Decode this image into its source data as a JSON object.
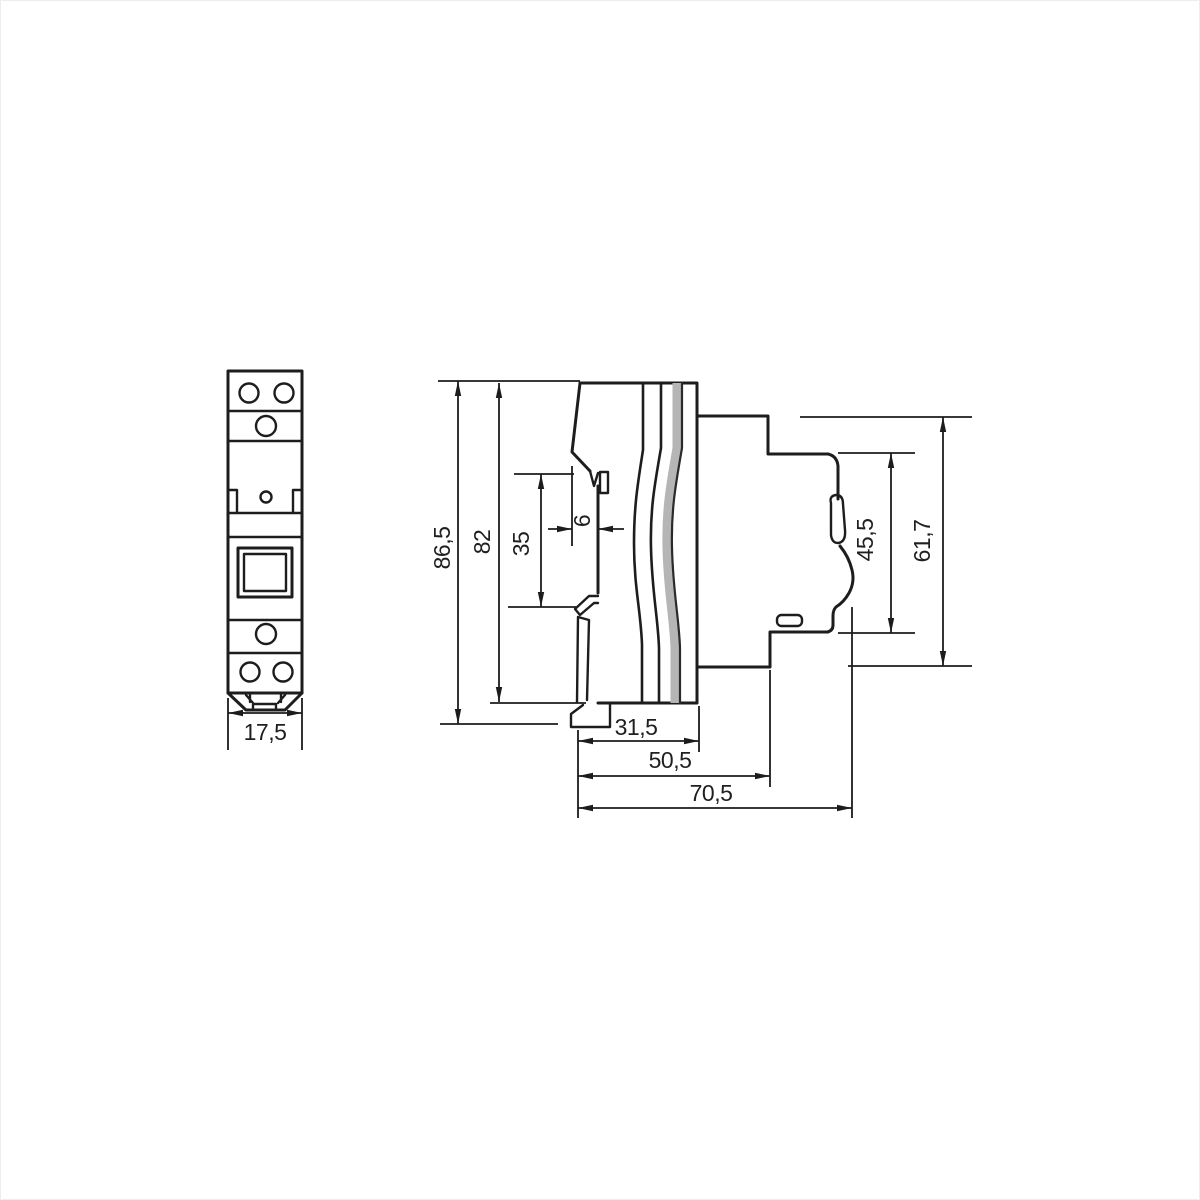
{
  "drawing": {
    "title": "DIN-rail modular device dimensional drawing",
    "views": {
      "front": {
        "name": "front-view"
      },
      "side": {
        "name": "side-view"
      }
    },
    "colors": {
      "line": "#1d1d1d",
      "background": "#ffffff",
      "seam_gray": "#b5b5b5"
    },
    "dims": {
      "front_width": {
        "label": "17,5"
      },
      "overall_height": {
        "label": "86,5"
      },
      "body_height": {
        "label": "82"
      },
      "rail_slot_height": {
        "label": "35"
      },
      "rail_hook_depth": {
        "label": "6"
      },
      "depth_rear": {
        "label": "31,5"
      },
      "depth_mid": {
        "label": "50,5"
      },
      "depth_total": {
        "label": "70,5"
      },
      "front_face_height": {
        "label": "45,5"
      },
      "front_section_height": {
        "label": "61,7"
      }
    }
  }
}
